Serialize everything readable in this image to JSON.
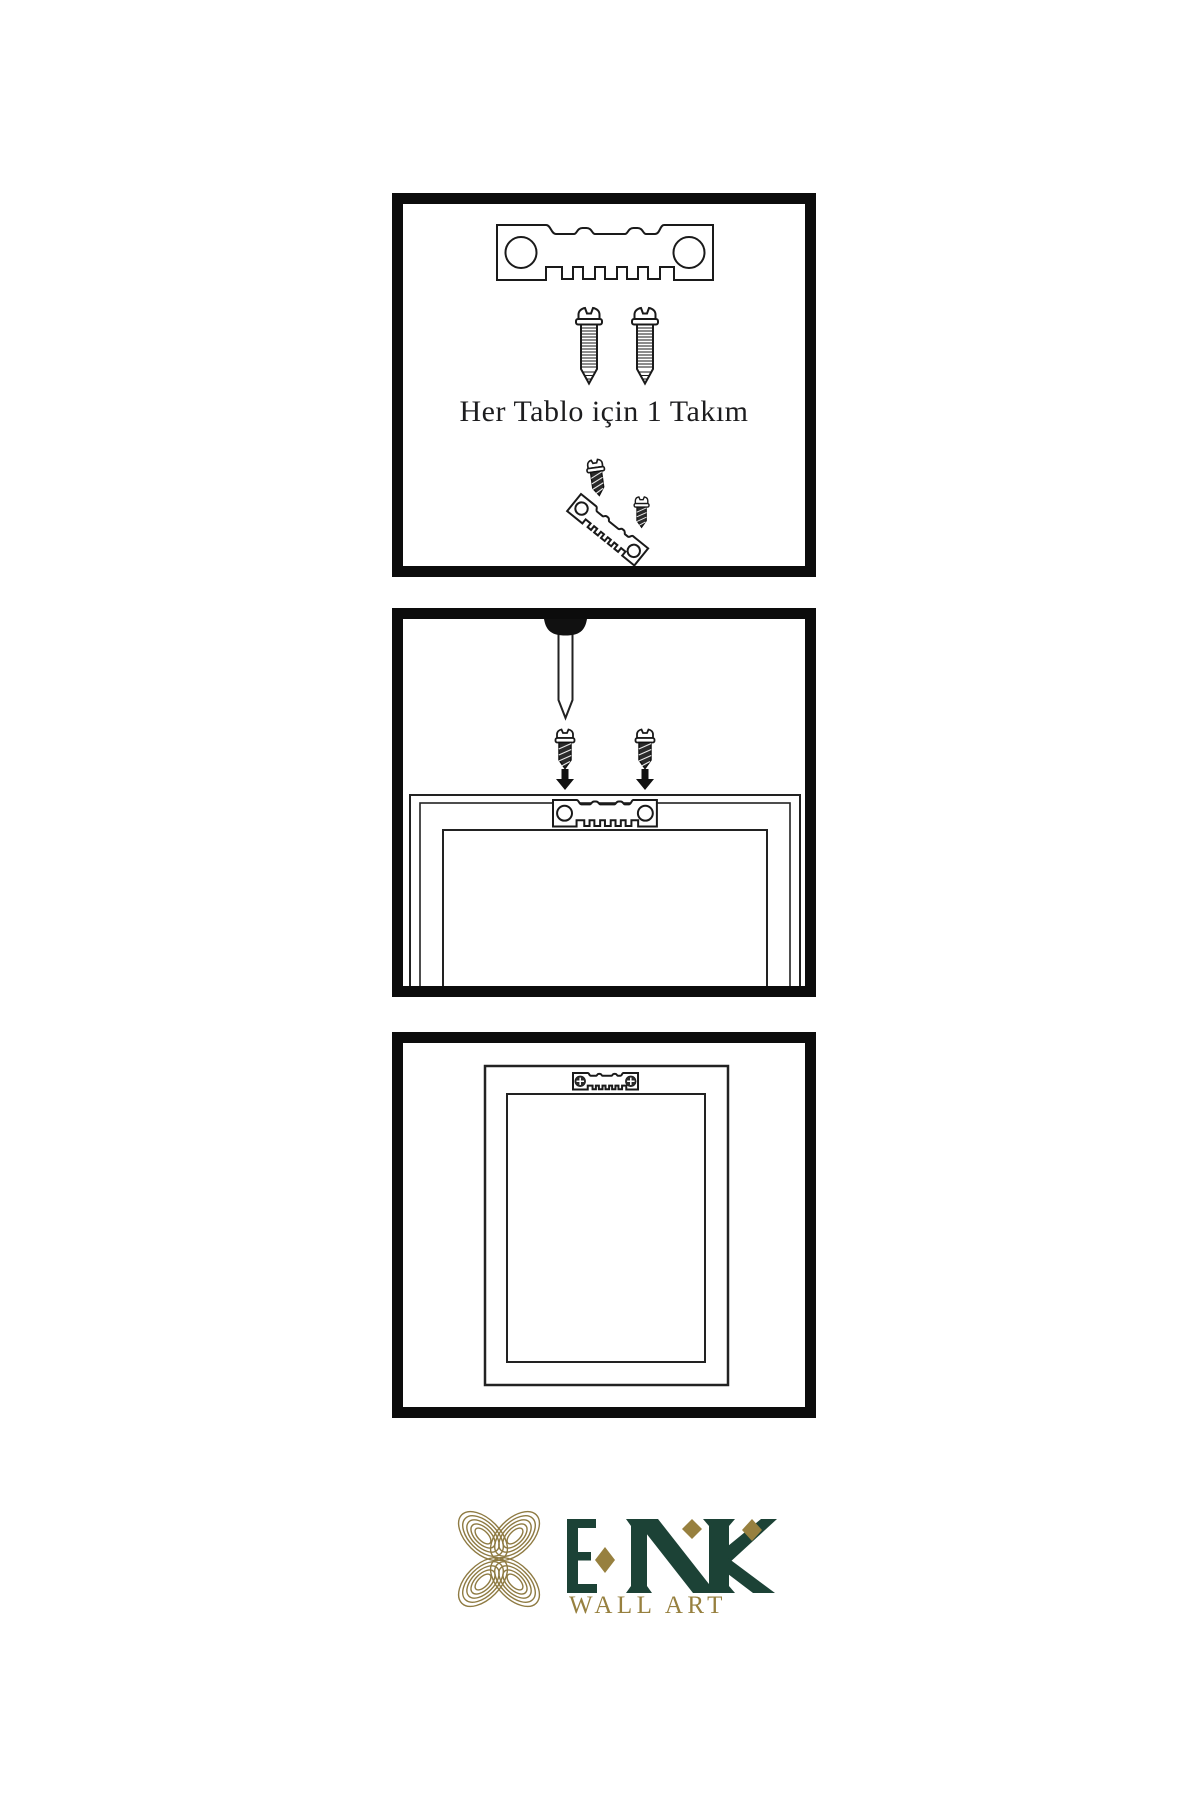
{
  "page": {
    "background": "#ffffff"
  },
  "panels": [
    {
      "name": "hardware-set",
      "caption": "Her Tablo için 1 Takım",
      "illustrations": [
        "sawtooth-hanger",
        "mounting-screw",
        "mounting-screw",
        "small-screw",
        "angled-sawtooth-hanger",
        "small-screw"
      ]
    },
    {
      "name": "attach-hanger-to-frame",
      "illustrations": [
        "wall-nail",
        "small-screw",
        "small-screw",
        "down-arrow",
        "down-arrow",
        "frame-back",
        "sawtooth-hanger"
      ]
    },
    {
      "name": "hanger-mounted-on-frame",
      "illustrations": [
        "frame-back",
        "sawtooth-hanger-with-screws"
      ]
    }
  ],
  "logo": {
    "brand": "ENK",
    "subtitle": "WALL ART",
    "brand_color": "#1c4236",
    "gold_color": "#97803f",
    "knot_color": "#8e7a42"
  },
  "ink_color": "#1a1a1a",
  "panel_border_color": "#0c0c0c"
}
